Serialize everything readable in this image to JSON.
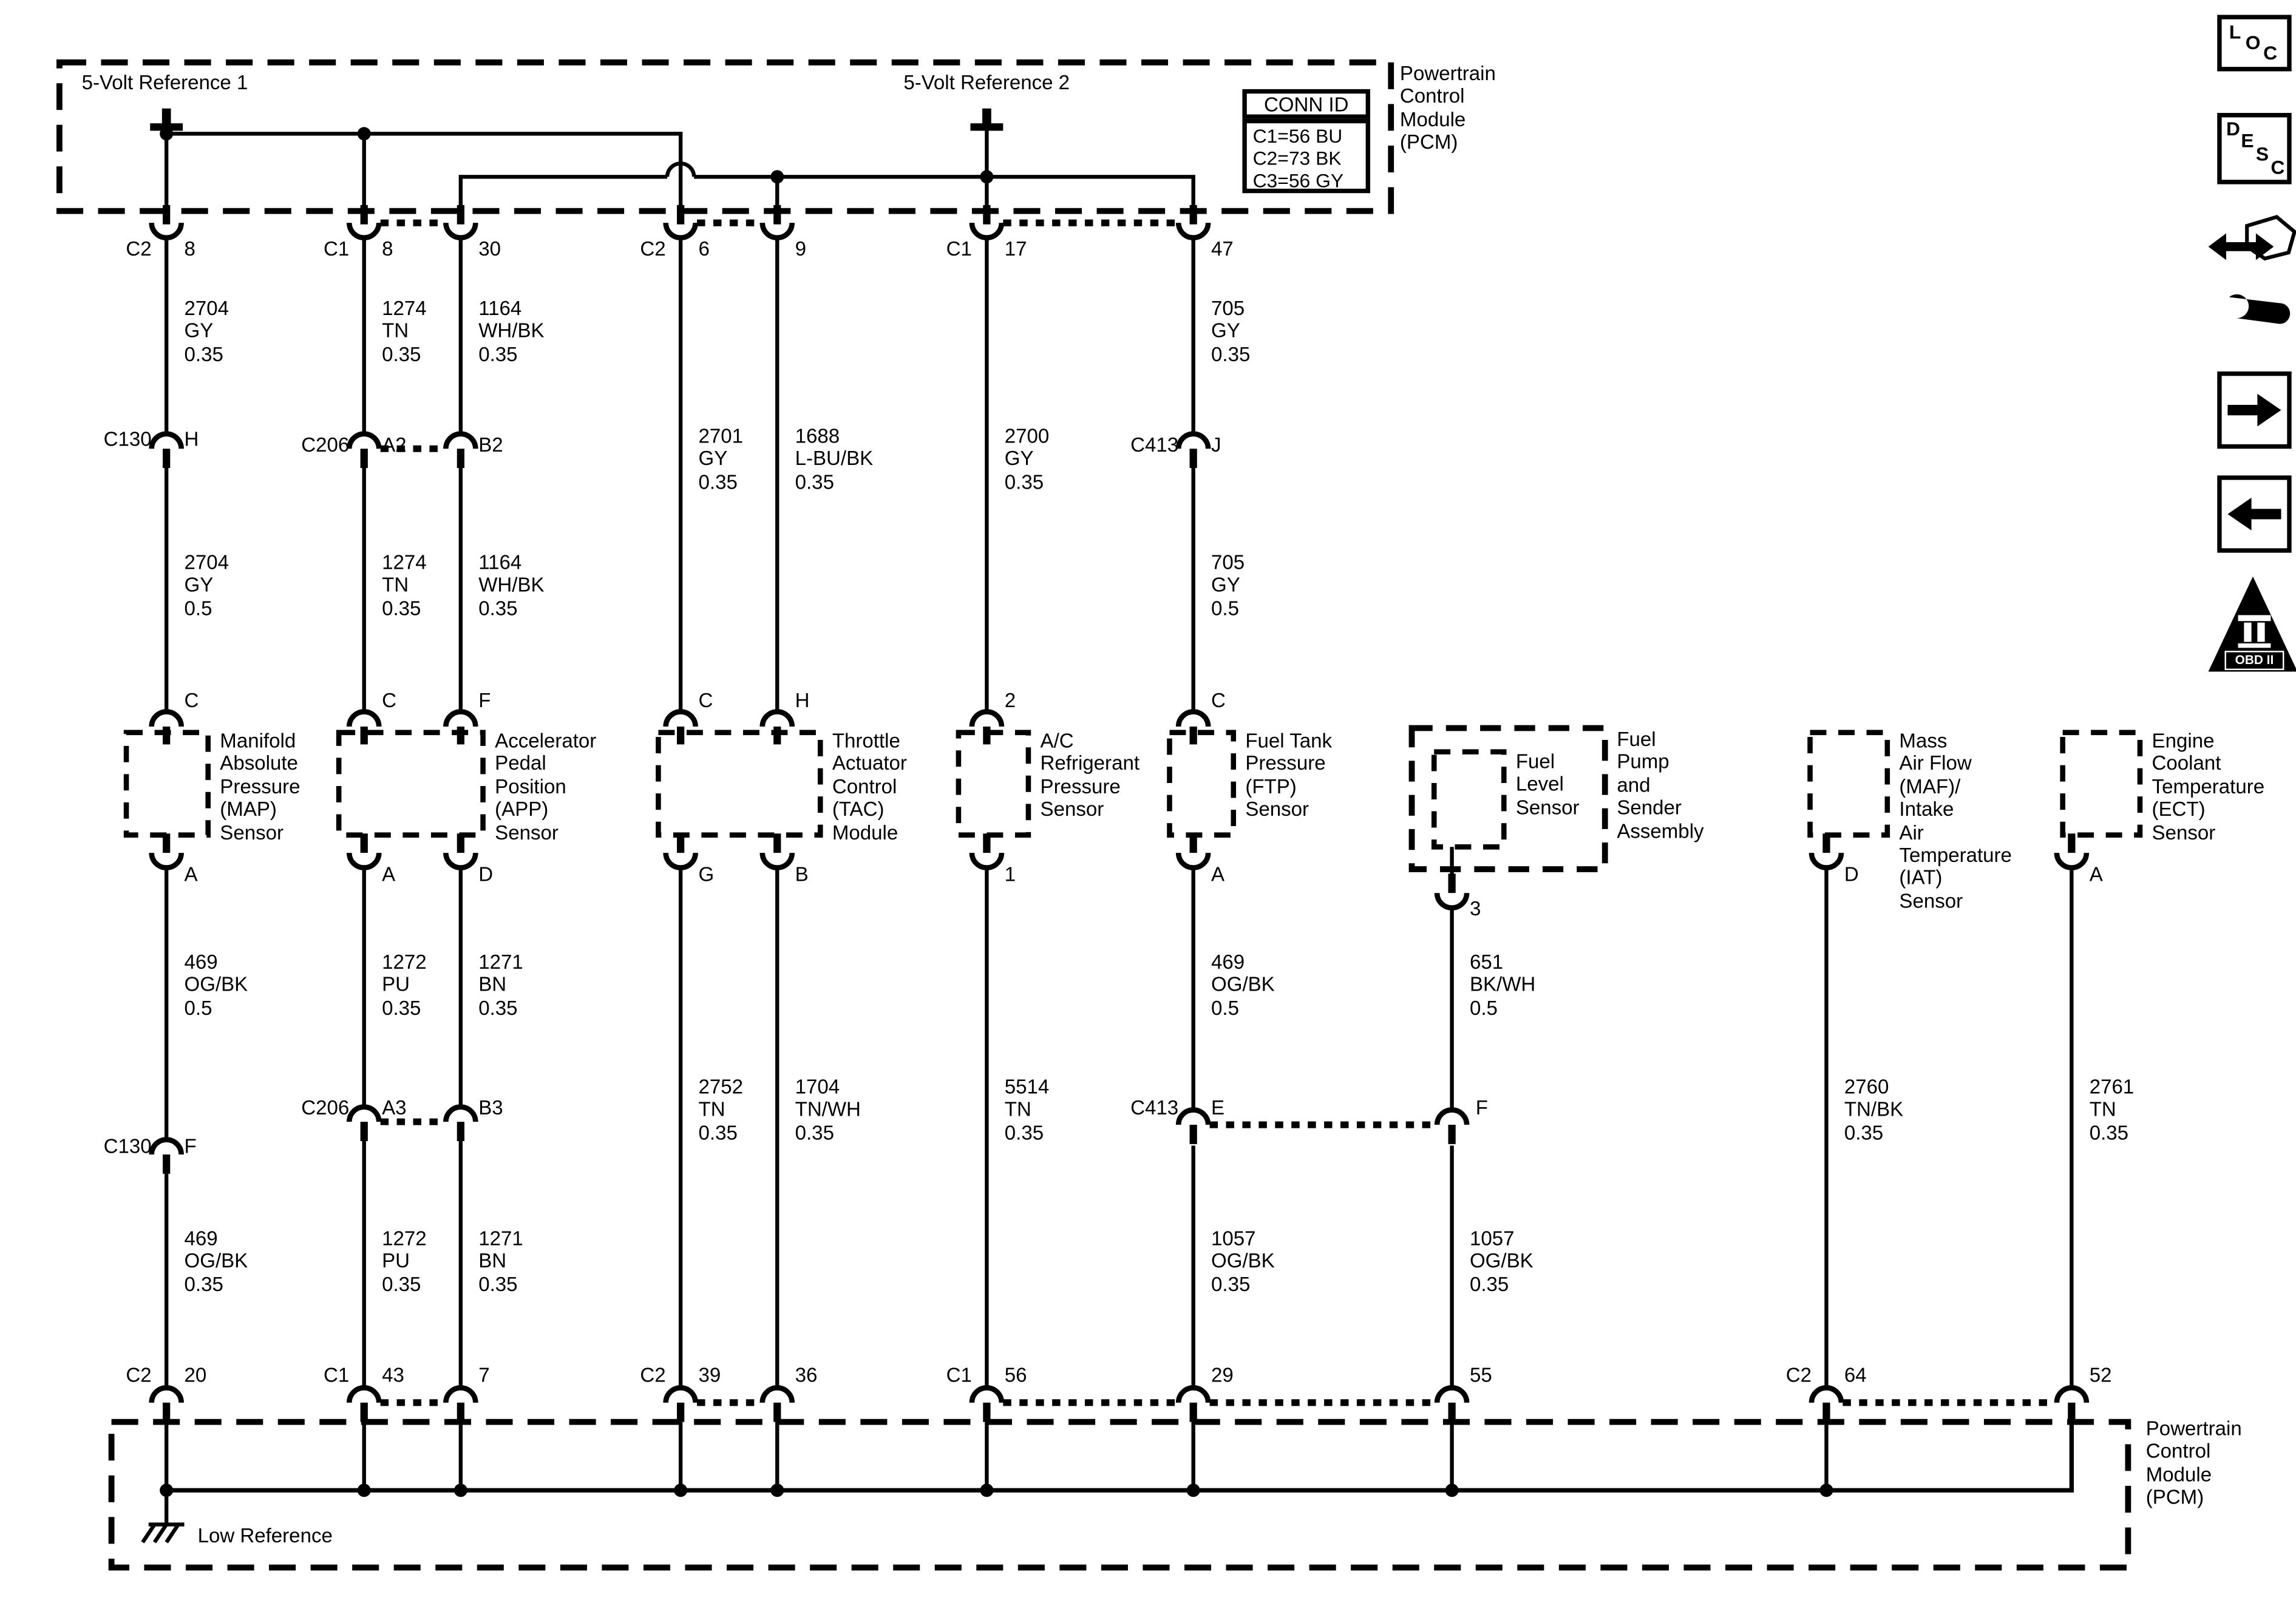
{
  "pcm_top": {
    "ref1": "5-Volt Reference 1",
    "ref2": "5-Volt Reference 2",
    "label": "Powertrain\nControl\nModule\n(PCM)",
    "conn_id_title": "CONN ID",
    "conn_id_rows": "C1=56 BU\nC2=73 BK\nC3=56 GY"
  },
  "row1": [
    {
      "conn": "C2",
      "pin": "8"
    },
    {
      "conn": "C1",
      "pin": "8"
    },
    {
      "conn": "",
      "pin": "30"
    },
    {
      "conn": "C2",
      "pin": "6"
    },
    {
      "conn": "",
      "pin": "9"
    },
    {
      "conn": "C1",
      "pin": "17"
    },
    {
      "conn": "",
      "pin": "47"
    }
  ],
  "wires1": [
    "2704\nGY\n0.35",
    "1274\nTN\n0.35",
    "1164\nWH/BK\n0.35",
    "705\nGY\n0.35"
  ],
  "row2": {
    "c130": {
      "conn": "C130",
      "pin": "H"
    },
    "c206": {
      "conn": "C206",
      "pinA": "A2",
      "pinB": "B2"
    },
    "c413": {
      "conn": "C413",
      "pin": "J"
    }
  },
  "wires2_mid": [
    "2701\nGY\n0.35",
    "1688\nL-BU/BK\n0.35",
    "2700\nGY\n0.35"
  ],
  "wires2": [
    "2704\nGY\n0.5",
    "1274\nTN\n0.35",
    "1164\nWH/BK\n0.35",
    "705\nGY\n0.5"
  ],
  "pins_top": [
    "C",
    "C",
    "F",
    "C",
    "H",
    "2",
    "C"
  ],
  "sensors": {
    "map": "Manifold\nAbsolute\nPressure\n(MAP)\nSensor",
    "app": "Accelerator\nPedal\nPosition\n(APP)\nSensor",
    "tac": "Throttle\nActuator\nControl\n(TAC)\nModule",
    "ac": "A/C\nRefrigerant\nPressure\nSensor",
    "ftp": "Fuel Tank\nPressure\n(FTP)\nSensor",
    "fuel_level": "Fuel\nLevel\nSensor",
    "fuel_pump": "Fuel\nPump\nand\nSender\nAssembly",
    "maf": "Mass\nAir Flow\n(MAF)/\nIntake\nAir\nTemperature\n(IAT)\nSensor",
    "ect": "Engine\nCoolant\nTemperature\n(ECT)\nSensor"
  },
  "pins_bottom": [
    "A",
    "A",
    "D",
    "G",
    "B",
    "1",
    "A",
    "3",
    "D",
    "A"
  ],
  "wires3": [
    "469\nOG/BK\n0.5",
    "1272\nPU\n0.35",
    "1271\nBN\n0.35",
    "469\nOG/BK\n0.5",
    "651\nBK/WH\n0.5"
  ],
  "wires_mid2": [
    "2752\nTN\n0.35",
    "1704\nTN/WH\n0.35",
    "5514\nTN\n0.35",
    "2760\nTN/BK\n0.35",
    "2761\nTN\n0.35"
  ],
  "row3": {
    "c206": {
      "conn": "C206",
      "pinA": "A3",
      "pinB": "B3"
    },
    "c413": {
      "conn": "C413",
      "pinA": "E",
      "pinB": "F"
    },
    "c130": {
      "conn": "C130",
      "pin": "F"
    }
  },
  "wires4": [
    "469\nOG/BK\n0.35",
    "1272\nPU\n0.35",
    "1271\nBN\n0.35",
    "1057\nOG/BK\n0.35",
    "1057\nOG/BK\n0.35"
  ],
  "row_bottom": [
    {
      "conn": "C2",
      "pin": "20"
    },
    {
      "conn": "C1",
      "pin": "43"
    },
    {
      "conn": "",
      "pin": "7"
    },
    {
      "conn": "C2",
      "pin": "39"
    },
    {
      "conn": "",
      "pin": "36"
    },
    {
      "conn": "C1",
      "pin": "56"
    },
    {
      "conn": "",
      "pin": "29"
    },
    {
      "conn": "",
      "pin": "55"
    },
    {
      "conn": "C2",
      "pin": "64"
    },
    {
      "conn": "",
      "pin": "52"
    }
  ],
  "pcm_bottom": {
    "label": "Powertrain\nControl\nModule\n(PCM)",
    "low_ref": "Low Reference"
  },
  "side_icons": {
    "loc": [
      "L",
      "O",
      "C"
    ],
    "desc": [
      "D",
      "E",
      "S",
      "C"
    ],
    "obd": "OBD II"
  }
}
